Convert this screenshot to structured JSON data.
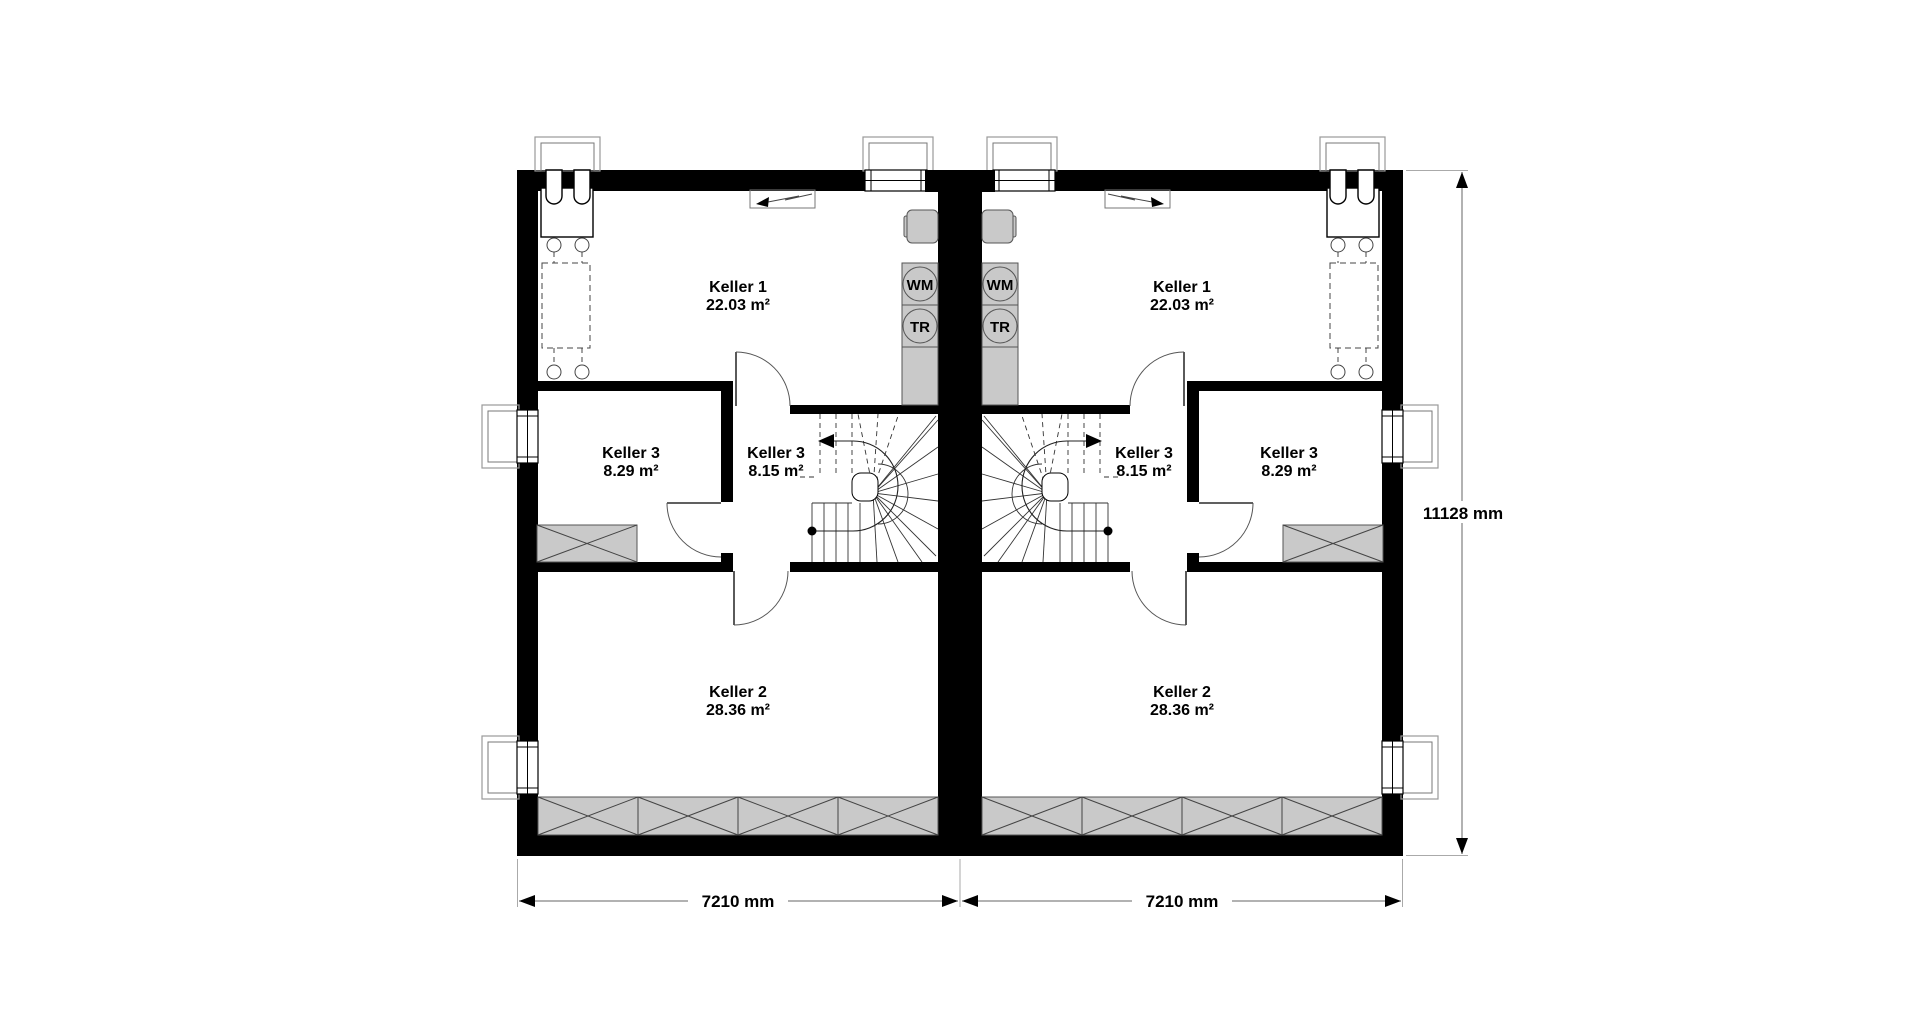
{
  "plan": {
    "dims": {
      "bottom_left": "7210 mm",
      "bottom_right": "7210 mm",
      "right_side": "11128 mm"
    },
    "left": {
      "keller1": {
        "label": "Keller 1",
        "area": "22.03 m²"
      },
      "keller3_side": {
        "label": "Keller 3",
        "area": "8.29 m²"
      },
      "keller3_stair": {
        "label": "Keller 3",
        "area": "8.15 m²"
      },
      "keller2": {
        "label": "Keller 2",
        "area": "28.36 m²"
      },
      "washer": "WM",
      "dryer": "TR"
    },
    "right": {
      "keller1": {
        "label": "Keller 1",
        "area": "22.03 m²"
      },
      "keller3_side": {
        "label": "Keller 3",
        "area": "8.29 m²"
      },
      "keller3_stair": {
        "label": "Keller 3",
        "area": "8.15 m²"
      },
      "keller2": {
        "label": "Keller 2",
        "area": "28.36 m²"
      },
      "washer": "WM",
      "dryer": "TR"
    },
    "colors": {
      "wall": "#000000",
      "fixture_gray": "#c9c9c9",
      "line_gray": "#9a9a9a"
    }
  }
}
